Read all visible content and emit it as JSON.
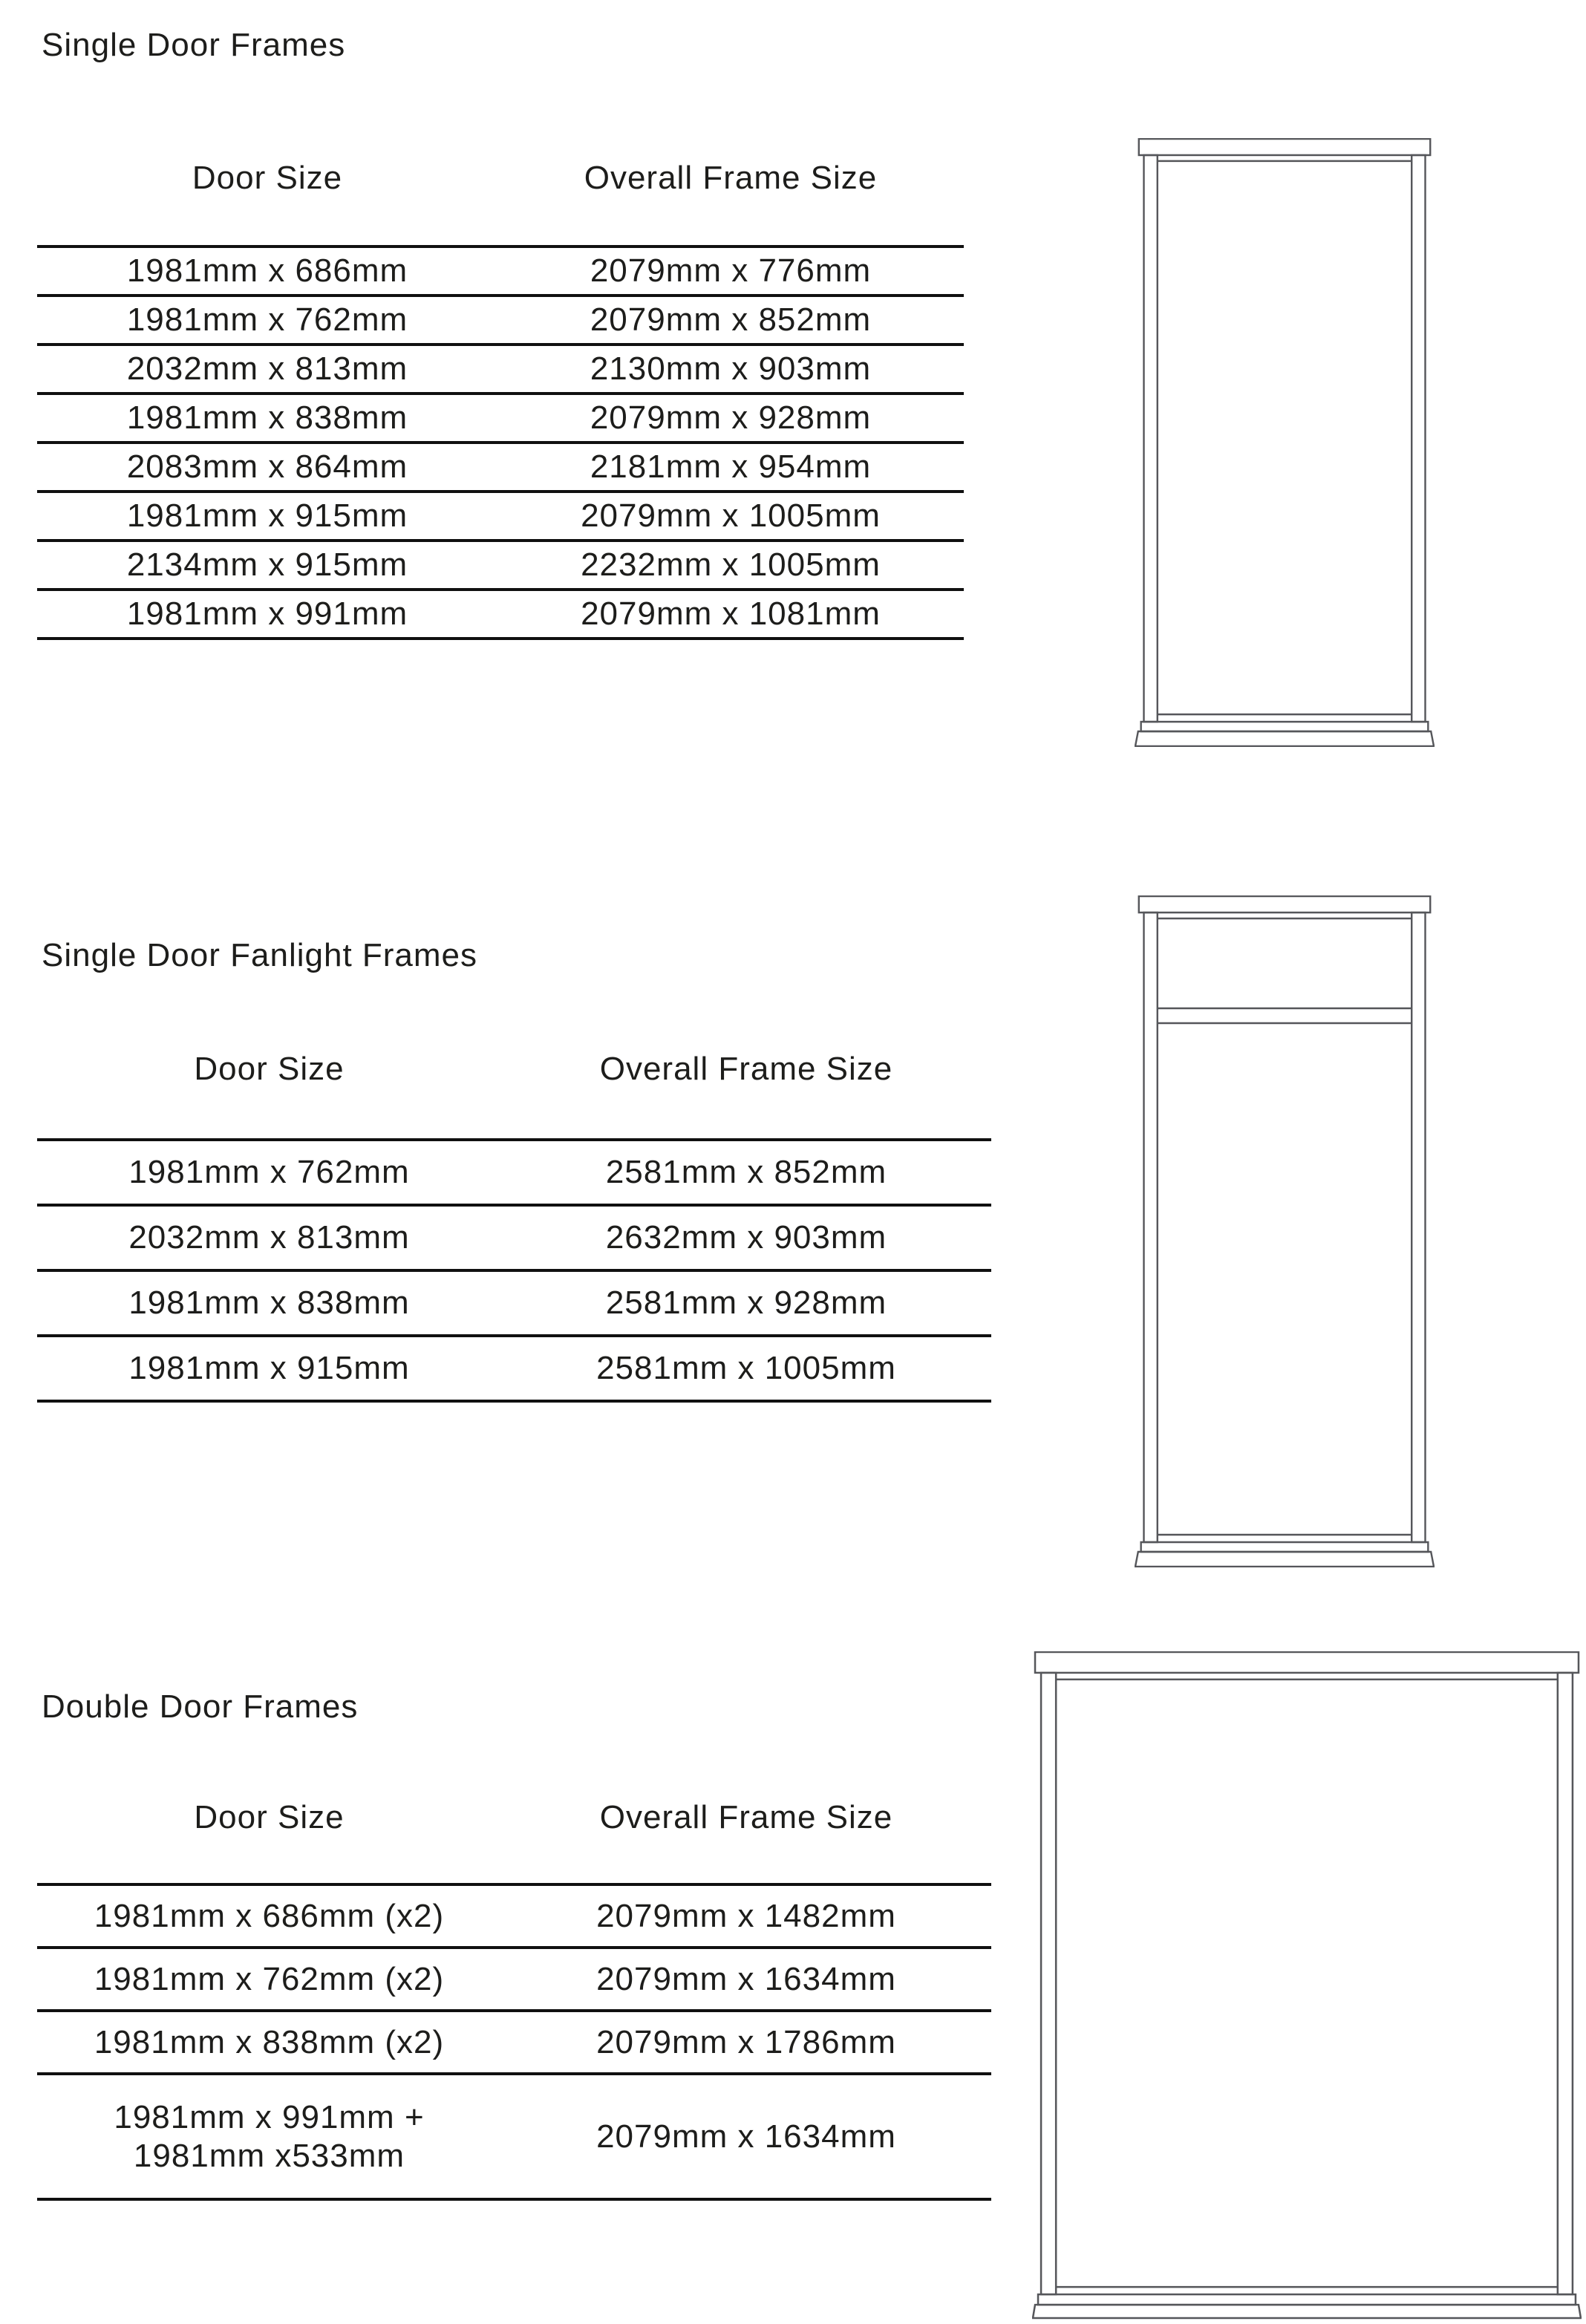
{
  "page": {
    "background": "#ffffff",
    "text_color": "#1d1d1b",
    "rule_color": "#101010",
    "diagram_line_color": "#55565a"
  },
  "sections": [
    {
      "title": "Single Door Frames",
      "headers": {
        "door": "Door Size",
        "frame": "Overall Frame Size"
      },
      "rows": [
        {
          "door": "1981mm x 686mm",
          "frame": "2079mm x 776mm"
        },
        {
          "door": "1981mm x 762mm",
          "frame": "2079mm x 852mm"
        },
        {
          "door": "2032mm x 813mm",
          "frame": "2130mm x 903mm"
        },
        {
          "door": "1981mm x 838mm",
          "frame": "2079mm x 928mm"
        },
        {
          "door": "2083mm x 864mm",
          "frame": "2181mm x 954mm"
        },
        {
          "door": "1981mm x 915mm",
          "frame": "2079mm x 1005mm"
        },
        {
          "door": "2134mm x 915mm",
          "frame": "2232mm x 1005mm"
        },
        {
          "door": "1981mm x 991mm",
          "frame": "2079mm x 1081mm"
        }
      ],
      "diagram": "single-door-frame"
    },
    {
      "title": "Single Door Fanlight Frames",
      "headers": {
        "door": "Door Size",
        "frame": "Overall Frame Size"
      },
      "rows": [
        {
          "door": "1981mm x 762mm",
          "frame": "2581mm x 852mm"
        },
        {
          "door": "2032mm x 813mm",
          "frame": "2632mm x 903mm"
        },
        {
          "door": "1981mm x 838mm",
          "frame": "2581mm x 928mm"
        },
        {
          "door": "1981mm x 915mm",
          "frame": "2581mm x 1005mm"
        }
      ],
      "diagram": "single-door-fanlight-frame"
    },
    {
      "title": "Double Door Frames",
      "headers": {
        "door": "Door Size",
        "frame": "Overall Frame Size"
      },
      "rows": [
        {
          "door": "1981mm x 686mm (x2)",
          "frame": "2079mm x 1482mm"
        },
        {
          "door": "1981mm x 762mm (x2)",
          "frame": "2079mm x 1634mm"
        },
        {
          "door": "1981mm x 838mm (x2)",
          "frame": "2079mm x 1786mm"
        },
        {
          "door": "1981mm x 991mm +",
          "door2": "1981mm x533mm",
          "frame": "2079mm x 1634mm"
        }
      ],
      "diagram": "double-door-frame"
    }
  ]
}
